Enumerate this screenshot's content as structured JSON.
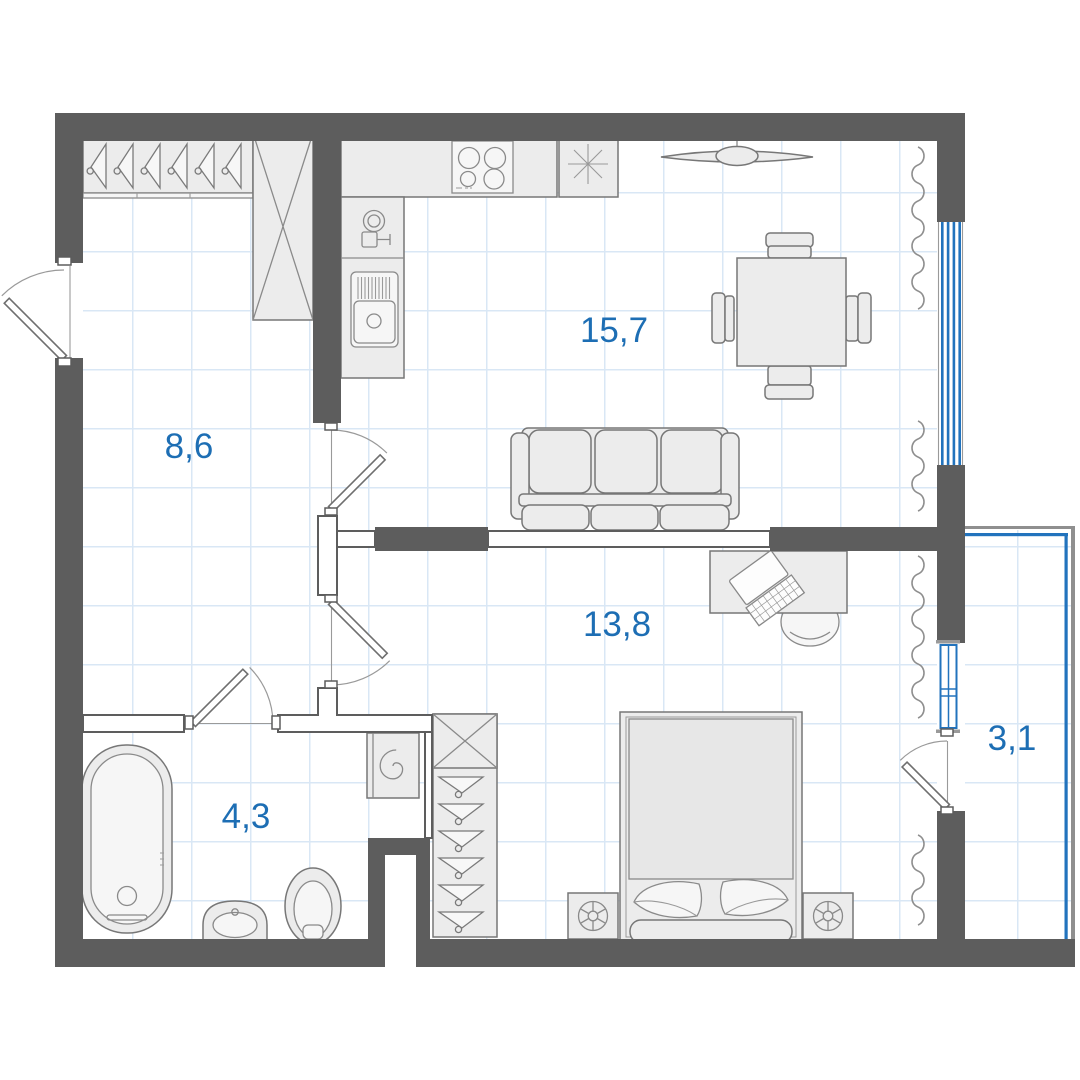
{
  "rooms": [
    {
      "name": "hallway",
      "area": "8,6"
    },
    {
      "name": "kitchen-living-room",
      "area": "15,7"
    },
    {
      "name": "bedroom",
      "area": "13,8"
    },
    {
      "name": "bathroom",
      "area": "4,3"
    },
    {
      "name": "balcony",
      "area": "3,1"
    }
  ],
  "colors": {
    "wall": "#5d5d5d",
    "window-blue": "#2273bd",
    "label-blue": "#1d6eb4",
    "grid-blue": "#d9e7f5",
    "furniture-fill": "#ececec",
    "furniture-stroke": "#777777",
    "background": "#ffffff"
  },
  "symbols": [
    "hanger-rail",
    "wardrobe",
    "kitchen-counter",
    "hob",
    "fridge",
    "kitchen-sink",
    "dining-table",
    "dining-chair",
    "ceiling-fan",
    "sofa",
    "desk",
    "laptop",
    "office-chair",
    "bed",
    "nightstand",
    "bathtub",
    "washbasin",
    "toilet",
    "washing-machine",
    "radiator",
    "window",
    "door"
  ]
}
